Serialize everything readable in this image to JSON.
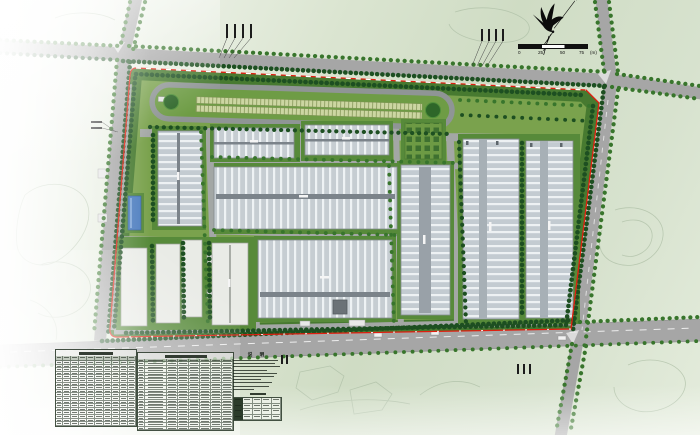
{
  "scale_bar": {
    "tick_labels": [
      "0",
      "25",
      "50",
      "75"
    ],
    "unit_label": "(m)"
  },
  "north_arrow": {
    "tip_glyph": "✳"
  },
  "notes_block": {
    "title": "说 明",
    "line_widths_pct": [
      92,
      86,
      95,
      70,
      90,
      84,
      58,
      80,
      74,
      42
    ],
    "sub_table": {
      "rows": 4,
      "cols": 5
    }
  },
  "tables": {
    "left_table": {
      "rows": 19,
      "cols": 10,
      "title_legible": false
    },
    "mid_table": {
      "rows": 21,
      "cols": 8,
      "title_legible": false
    }
  },
  "annotations": {
    "groups": [
      {
        "x": 226,
        "y": 24,
        "n": 4,
        "gap": 8,
        "h": 14,
        "leader": {
          "tx": 219,
          "ty": 58,
          "spread": 5
        }
      },
      {
        "x": 481,
        "y": 29,
        "n": 4,
        "gap": 7,
        "h": 12,
        "leader": {
          "tx": 472,
          "ty": 66,
          "spread": 5
        }
      },
      {
        "x": 91,
        "y": 121,
        "n": 2,
        "gap": 6,
        "h": 11,
        "horizontal": true,
        "leader": {
          "tx": 116,
          "ty": 132,
          "spread": 2
        }
      },
      {
        "x": 281,
        "y": 355,
        "n": 2,
        "gap": 5,
        "h": 9
      },
      {
        "x": 517,
        "y": 364,
        "n": 3,
        "gap": 6,
        "h": 10
      }
    ]
  },
  "colors": {
    "boundary_red": "#e01f10",
    "site_green": "#7aa24d",
    "belt_green": "#46792f",
    "road_gray": "#a6a6a6",
    "roof_gray": "#c6cdd2",
    "blue_building": "#4f7fc0",
    "tree_dark": "#1d4f21"
  },
  "map_features": [
    "perimeter-roads",
    "site-boundary-red-line",
    "test-track-loop",
    "warehouse-buildings",
    "dormitory-cluster",
    "blue-roof-building",
    "utility-yard",
    "tree-rows",
    "entrance-gates",
    "parked-vehicles"
  ]
}
